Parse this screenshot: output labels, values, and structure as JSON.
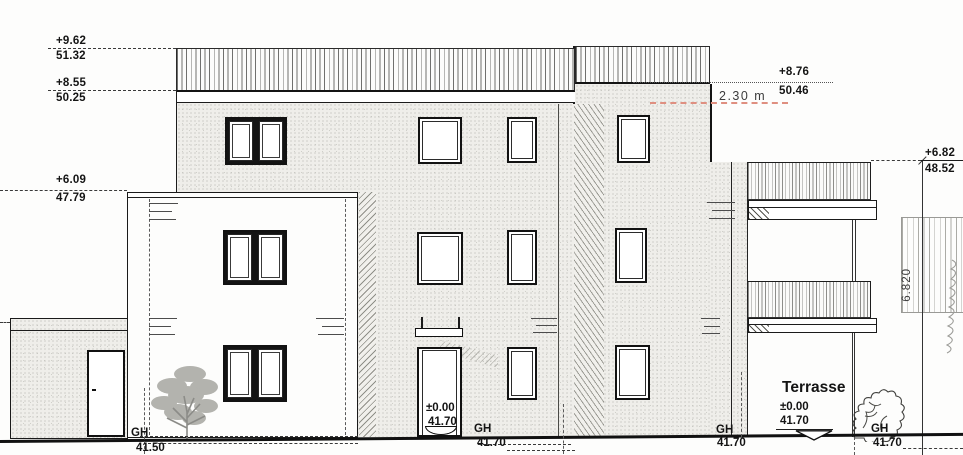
{
  "drawing_type": "building front elevation (architectural drawing)",
  "colors": {
    "line": "#1c1c1c",
    "red_dashed_marker": "#df8f80",
    "facade_stipple": "#efeeea"
  },
  "levels_left": [
    {
      "top": "+9.62",
      "bottom": "51.32"
    },
    {
      "top": "+8.55",
      "bottom": "50.25"
    },
    {
      "top": "+6.09",
      "bottom": "47.79"
    }
  ],
  "levels_right": [
    {
      "top": "+8.76",
      "bottom": "50.46"
    },
    {
      "top": "+6.82",
      "bottom": "48.52"
    }
  ],
  "dims": {
    "offset": "2.30 m",
    "height_right": "6.820"
  },
  "entrance": {
    "level": "±0.00",
    "absolute": "41.70"
  },
  "terrace": {
    "title": "Terrasse",
    "level": "±0.00",
    "absolute": "41.70"
  },
  "ground": {
    "gh1": {
      "label": "GH",
      "value": "41.50"
    },
    "gh2": {
      "label": "GH",
      "value": "41.70"
    },
    "gh3": {
      "label": "GH",
      "value": "41.70"
    },
    "gh4": {
      "label": "GH",
      "value": "41.70"
    }
  }
}
